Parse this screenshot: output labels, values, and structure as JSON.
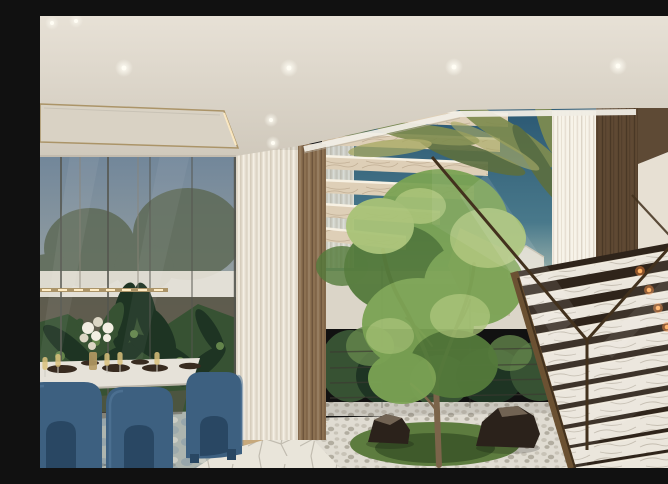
{
  "scene": {
    "title": "Luxury villa atrium interior rendering",
    "description": "Photorealistic rendering of a double-height villa atrium: a dining area with navy-blue velvet chairs and a set table beside floor-to-ceiling glazing with tropical garden views, sheer curtains and wood slat panels, a central indoor tree growing from a white-pebble rock garden with black boulders and moss, floating marble stair treads crossing the upper atrium against a deep blue sky with palm fronds, and a marble open-riser staircase with bronze-framed glass balustrade and warm under-tread lighting rising to an upper hallway.",
    "objects": [
      "ceiling-spotlights",
      "dropped-ceiling-panel",
      "linear-pendant-light",
      "dining-table",
      "blue-velvet-chairs",
      "wine-glasses",
      "charger-plates",
      "white-flower-centerpiece",
      "sheer-curtains",
      "wood-slat-panels",
      "tropical-garden-glazing",
      "olive-trees",
      "floating-marble-stairs",
      "palm-fronds",
      "indoor-tree",
      "pebble-garden",
      "black-rocks",
      "moss-bed",
      "flagstone-floor",
      "area-rug",
      "wood-floor-strip",
      "led-floor-strip",
      "marble-staircase",
      "under-tread-lights",
      "glass-bronze-balustrade",
      "upper-hallway",
      "garden-house"
    ],
    "lighting": {
      "ceiling_spotlights": 8,
      "under_tread_lights": 8,
      "pendant": "linear gold bar with point lights",
      "led_floor_strip": 1
    },
    "time_of_day": "dusk"
  },
  "palette": {
    "ceilingTop": "#e7e1d6",
    "ceilingBottom": "#d0c9bc",
    "fascia": "#f0ede5",
    "panelFill": "#d9d2c4",
    "trimGold": "#ab9468",
    "spotCore": "#fffdf4",
    "skyTop": "#71869a",
    "skyMid": "#9aa3a2",
    "skyHorizon": "#c7ab8c",
    "olive": "#5e6a57",
    "frost": "#eae6db",
    "plantDark": "#1e3423",
    "plantMid": "#375233",
    "plantLight": "#63844b",
    "curtain": "#e8e1d3",
    "curtainShade": "#d2c9b9",
    "curtainHi": "#f7f3e9",
    "wood": "#8b7051",
    "woodLine": "#6a523a",
    "woodDark": "#5f4933",
    "woodDarkLine": "#4a3826",
    "soffit": "#5e4a35",
    "atriumSkyTop": "#2b5873",
    "atriumSkyMid": "#49798b",
    "atriumHaze": "#a9bcb2",
    "wallWhite": "#e7e0d3",
    "wallBeige": "#cabeaa",
    "greyGlass": "#94897b",
    "palm": "#7f8c4f",
    "palmDark": "#5c6f40",
    "palmLight": "#a8a964",
    "slab": "#decfb7",
    "slabEdge": "#f7f1e3",
    "slabShadow": "#b5a286",
    "tree": "#7ba354",
    "treeDark": "#547a3b",
    "treeLight": "#a9c377",
    "trunk": "#7b644a",
    "pebbleBg": "#e0dcd2",
    "pebbleA": "#c8c3b7",
    "pebbleB": "#b2ada0",
    "moss": "#5d7c3f",
    "mossDark": "#3f5a2b",
    "rock": "#2b221b",
    "rockHi": "#7e6f5d",
    "flag": "#e9e5da",
    "flagLine": "#b7b2a5",
    "stairMarble": "#ebe6dc",
    "stairVein": "#b6afa1",
    "stairGap": "#2f241a",
    "treadLight": "#ffb061",
    "treadGlow": "#ff8f3d",
    "bronze": "#6b5132",
    "bronzeDark": "#42311d",
    "chair": "#3d6080",
    "chairShadow": "#294763",
    "chairHi": "#5a7da0",
    "tableTop": "#e6e2d9",
    "underTable": "#5f574a",
    "plate": "#382b20",
    "champagne": "#d9c17b",
    "rug": "#adb5af",
    "rugBlue": "#8499a8",
    "woodFloor": "#c7a97c",
    "led": "#ffecc4",
    "flowerWhite": "#f2eee2",
    "flowerShade": "#dcd6c4",
    "vaseGold": "#b49a63",
    "railingDark": "#3c3a32",
    "mullion": "#55564f"
  }
}
